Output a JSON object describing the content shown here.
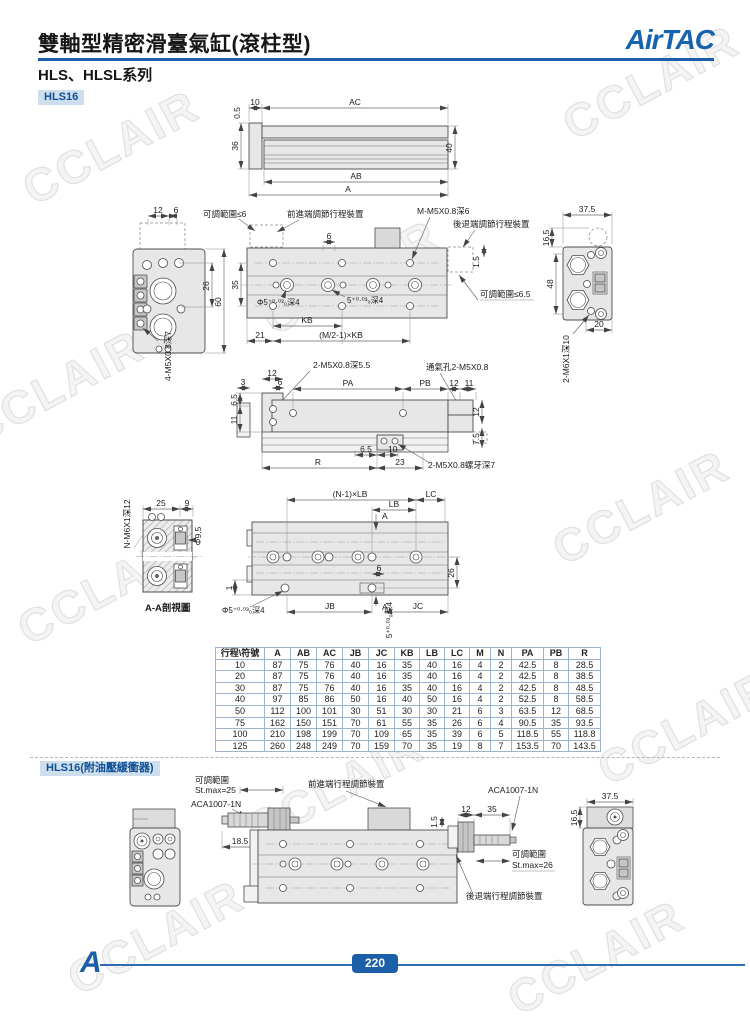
{
  "header": {
    "title": "雙軸型精密滑臺氣缸(滾柱型)",
    "series": "HLS、HLSL系列",
    "logo": "AirTAC",
    "accent": "#1b5fa8"
  },
  "watermark": {
    "text": "CCLAIR"
  },
  "badge1": "HLS16",
  "badge2": "HLS16(附油壓緩衝器)",
  "d1": {
    "t05": "0.5",
    "t10": "10",
    "ac": "AC",
    "h36": "36",
    "h40": "40",
    "ab": "AB",
    "a": "A"
  },
  "d2l": {
    "t12": "12",
    "t6": "6",
    "h26": "26",
    "h60": "60",
    "thread": "4-M5X0.8深7"
  },
  "d2c": {
    "adj1": "可調範圍≤6",
    "fwd": "前進端調節行程裝置",
    "m": "M-M5X0.8深6",
    "bwd": "後退端調節行程裝置",
    "t15": "1.5",
    "adj2": "可調範圍≤6.5",
    "t6": "6",
    "h35": "35",
    "cb1": "Φ5⁺⁰·⁰³₀深4",
    "cb2": "5⁺⁰·⁰³₀深4",
    "kb": "KB",
    "t21": "21",
    "mkb": "(M/2-1)×KB"
  },
  "d2r": {
    "w375": "37.5",
    "t165": "16.5",
    "h48": "48",
    "t20": "20",
    "thread": "2-M6X1深10"
  },
  "d3": {
    "l1": "2-M5X0.8深5.5",
    "l2": "通氣孔2-M5X0.8",
    "t3": "3",
    "t12": "12",
    "t6": "6",
    "pa": "PA",
    "pb": "PB",
    "t12b": "12",
    "t11": "11",
    "r12": "12",
    "r75": "7.5",
    "l65": "6.5",
    "l11": "11",
    "b65": "6.5",
    "b10": "10",
    "r": "R",
    "t23": "23",
    "l3": "2-M5X0.8螺牙深7"
  },
  "d4l": {
    "thread": "N-M6X1深12",
    "t25": "25",
    "t9": "9",
    "d95": "Φ9.5",
    "cap": "A-A剖視圖"
  },
  "d4c": {
    "nlb": "(N-1)×LB",
    "lc": "LC",
    "lb": "LB",
    "a1": "A",
    "h26": "26",
    "t6": "6",
    "t1": "1",
    "cb1": "Φ5⁺⁰·⁰³₀深4",
    "a2": "A",
    "cb2": "5⁺⁰·⁰³₀深4",
    "jb": "JB",
    "jc": "JC"
  },
  "table": {
    "headers": [
      "行程\\符號",
      "A",
      "AB",
      "AC",
      "JB",
      "JC",
      "KB",
      "LB",
      "LC",
      "M",
      "N",
      "PA",
      "PB",
      "R"
    ],
    "rows": [
      [
        "10",
        "87",
        "75",
        "76",
        "40",
        "16",
        "35",
        "40",
        "16",
        "4",
        "2",
        "42.5",
        "8",
        "28.5"
      ],
      [
        "20",
        "87",
        "75",
        "76",
        "40",
        "16",
        "35",
        "40",
        "16",
        "4",
        "2",
        "42.5",
        "8",
        "38.5"
      ],
      [
        "30",
        "87",
        "75",
        "76",
        "40",
        "16",
        "35",
        "40",
        "16",
        "4",
        "2",
        "42.5",
        "8",
        "48.5"
      ],
      [
        "40",
        "97",
        "85",
        "86",
        "50",
        "16",
        "40",
        "50",
        "16",
        "4",
        "2",
        "52.5",
        "8",
        "58.5"
      ],
      [
        "50",
        "112",
        "100",
        "101",
        "30",
        "51",
        "30",
        "30",
        "21",
        "6",
        "3",
        "63.5",
        "12",
        "68.5"
      ],
      [
        "75",
        "162",
        "150",
        "151",
        "70",
        "61",
        "55",
        "35",
        "26",
        "6",
        "4",
        "90.5",
        "35",
        "93.5"
      ],
      [
        "100",
        "210",
        "198",
        "199",
        "70",
        "109",
        "65",
        "35",
        "39",
        "6",
        "5",
        "118.5",
        "55",
        "118.8"
      ],
      [
        "125",
        "260",
        "248",
        "249",
        "70",
        "159",
        "70",
        "35",
        "19",
        "8",
        "7",
        "153.5",
        "70",
        "143.5"
      ]
    ]
  },
  "s2": {
    "rng1a": "可調範圍",
    "rng1b": "St.max=25",
    "aca1": "ACA1007-1N",
    "fwd": "前進端行程調節裝置",
    "t185": "18.5",
    "t12": "12",
    "t35": "35",
    "t15": "1.5",
    "aca2": "ACA1007-1N",
    "rng2a": "可調範圍",
    "rng2b": "St.max=26",
    "bwd": "後退端行程調節裝置",
    "w375": "37.5",
    "t165": "16.5"
  },
  "footer": {
    "page": "220",
    "logo_mark": "A"
  }
}
